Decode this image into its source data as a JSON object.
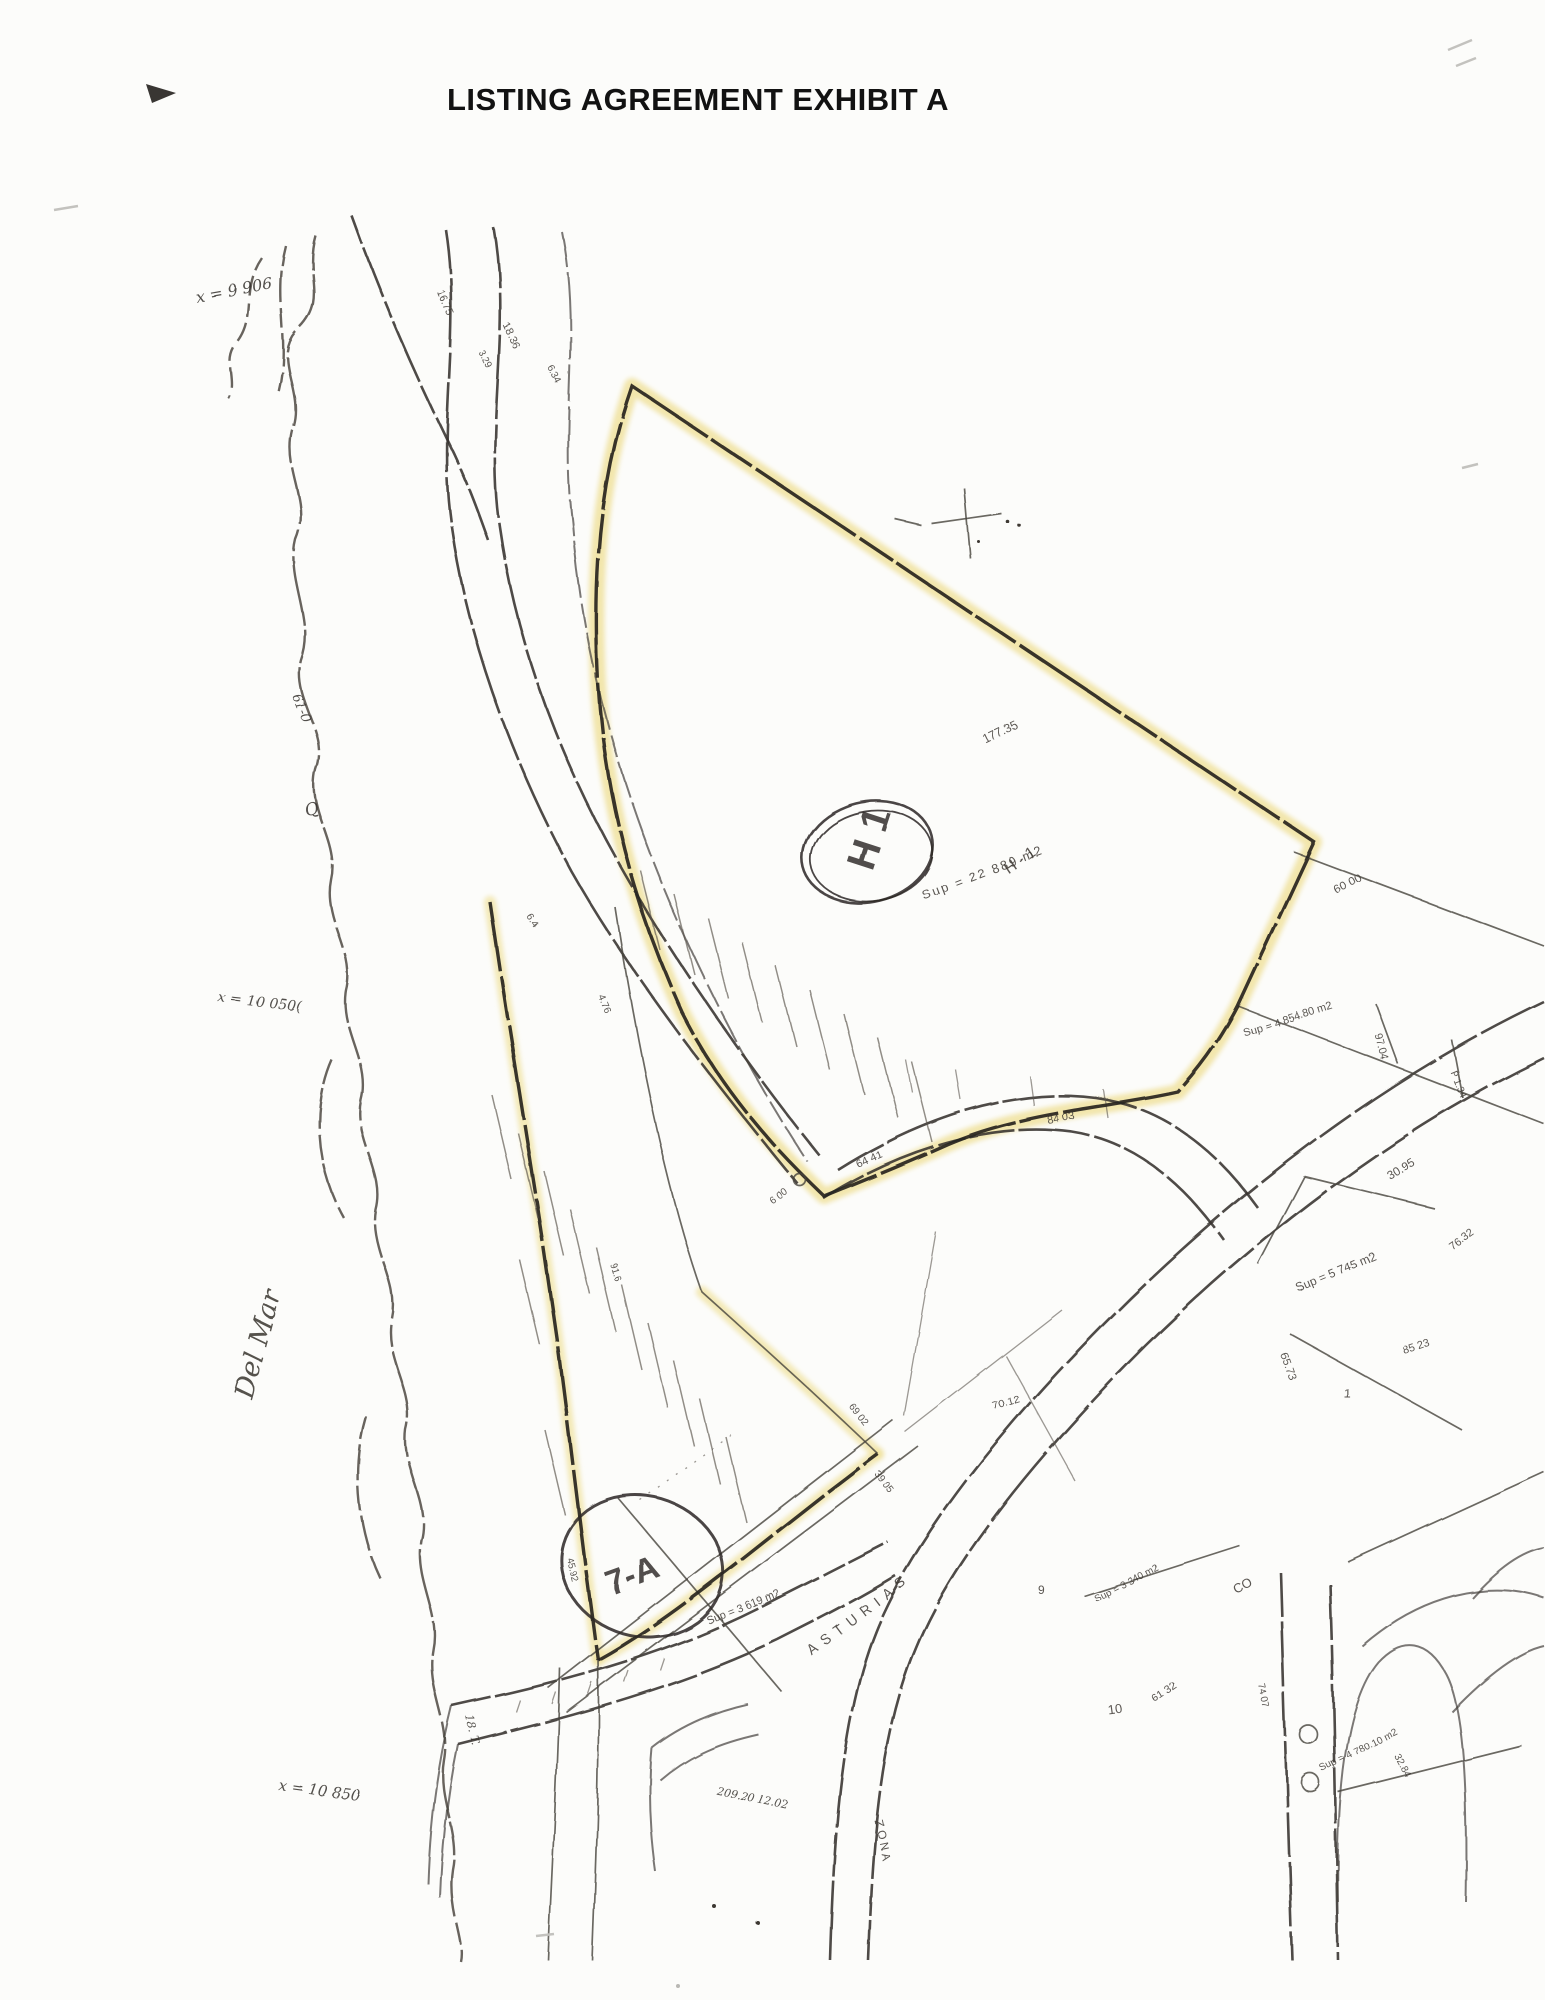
{
  "page": {
    "title": "LISTING AGREEMENT EXHIBIT A"
  },
  "colors": {
    "highlight": "#efe098",
    "ink": "#2f2b27",
    "paper": "#fcfcfa",
    "artifact_gray": "#c3c2be"
  },
  "map": {
    "stamps": {
      "h1_parcel": {
        "label": "H 1"
      },
      "parcel_7a": {
        "label": "7-A"
      }
    },
    "labels": [
      {
        "t": "x = 9 906",
        "x": 196,
        "y": 302,
        "r": -10,
        "s": 16,
        "f": "hand"
      },
      {
        "t": "16.75",
        "x": 437,
        "y": 292,
        "r": 66,
        "s": 11
      },
      {
        "t": "18.36",
        "x": 503,
        "y": 325,
        "r": 66,
        "s": 11
      },
      {
        "t": "3.29",
        "x": 478,
        "y": 352,
        "r": 62,
        "s": 10
      },
      {
        "t": "6.34",
        "x": 548,
        "y": 368,
        "r": 62,
        "s": 10
      },
      {
        "t": "61-0",
        "x": 292,
        "y": 696,
        "r": 68,
        "s": 13,
        "f": "hand"
      },
      {
        "t": "Q",
        "x": 306,
        "y": 816,
        "r": -15,
        "s": 17,
        "f": "hand"
      },
      {
        "t": "x = 10 050(",
        "x": 218,
        "y": 1002,
        "r": 6,
        "s": 14,
        "f": "hand"
      },
      {
        "t": "Del Mar",
        "x": 252,
        "y": 1400,
        "r": -75,
        "s": 27,
        "f": "script"
      },
      {
        "t": "177.35",
        "x": 986,
        "y": 744,
        "r": -26,
        "s": 12
      },
      {
        "t": "H - 1",
        "x": 1008,
        "y": 874,
        "r": -34,
        "s": 16
      },
      {
        "t": "Sup = 22 889 m2",
        "x": 924,
        "y": 900,
        "r": -21,
        "s": 13,
        "ls": 2
      },
      {
        "t": "60 00",
        "x": 1336,
        "y": 894,
        "r": -27,
        "s": 12
      },
      {
        "t": "Sup = 4 854.80 m2",
        "x": 1244,
        "y": 1036,
        "r": -17,
        "s": 11
      },
      {
        "t": "97.04",
        "x": 1374,
        "y": 1034,
        "r": 74,
        "s": 11
      },
      {
        "t": "P 1.34",
        "x": 1450,
        "y": 1072,
        "r": 68,
        "s": 10
      },
      {
        "t": "30.95",
        "x": 1390,
        "y": 1180,
        "r": -30,
        "s": 12
      },
      {
        "t": "76.32",
        "x": 1452,
        "y": 1250,
        "r": -36,
        "s": 11
      },
      {
        "t": "Sup = 5 745 m2",
        "x": 1298,
        "y": 1292,
        "r": -23,
        "s": 12
      },
      {
        "t": "65.73",
        "x": 1280,
        "y": 1354,
        "r": 71,
        "s": 11
      },
      {
        "t": "85 23",
        "x": 1404,
        "y": 1354,
        "r": -18,
        "s": 11
      },
      {
        "t": "1",
        "x": 1344,
        "y": 1398,
        "r": 0,
        "s": 13
      },
      {
        "t": "64 41",
        "x": 858,
        "y": 1168,
        "r": -24,
        "s": 11
      },
      {
        "t": "84 03",
        "x": 1048,
        "y": 1124,
        "r": -11,
        "s": 11
      },
      {
        "t": "6 00",
        "x": 772,
        "y": 1204,
        "r": -35,
        "s": 10
      },
      {
        "t": "70.12",
        "x": 994,
        "y": 1410,
        "r": -17,
        "s": 11
      },
      {
        "t": "Sup = 3 340 m2",
        "x": 1096,
        "y": 1602,
        "r": -27,
        "s": 10
      },
      {
        "t": "ASTURIAS",
        "x": 812,
        "y": 1656,
        "r": -37,
        "s": 14,
        "ls": 7
      },
      {
        "t": "61 32",
        "x": 1154,
        "y": 1702,
        "r": -34,
        "s": 11
      },
      {
        "t": "CO",
        "x": 1236,
        "y": 1594,
        "r": -28,
        "s": 13
      },
      {
        "t": "10",
        "x": 1108,
        "y": 1714,
        "r": -8,
        "s": 13
      },
      {
        "t": "9",
        "x": 1038,
        "y": 1594,
        "r": 0,
        "s": 12
      },
      {
        "t": "74 07",
        "x": 1258,
        "y": 1684,
        "r": 78,
        "s": 10
      },
      {
        "t": "32.84",
        "x": 1394,
        "y": 1756,
        "r": 62,
        "s": 10
      },
      {
        "t": "Sup = 4 780.10 m2",
        "x": 1322,
        "y": 1772,
        "r": -27,
        "s": 10
      },
      {
        "t": "209.20  12.02",
        "x": 716,
        "y": 1794,
        "r": 12,
        "s": 11,
        "f": "hand"
      },
      {
        "t": "ZONA",
        "x": 874,
        "y": 1820,
        "r": 78,
        "s": 12,
        "ls": 3
      },
      {
        "t": "45.92",
        "x": 566,
        "y": 1558,
        "r": 76,
        "s": 10
      },
      {
        "t": "x = 10 850",
        "x": 278,
        "y": 1790,
        "r": 8,
        "s": 15,
        "f": "hand"
      },
      {
        "t": "18. T.",
        "x": 466,
        "y": 1716,
        "r": 78,
        "s": 11,
        "f": "hand"
      },
      {
        "t": "4.76",
        "x": 598,
        "y": 996,
        "r": 68,
        "s": 10
      },
      {
        "t": "6.4",
        "x": 526,
        "y": 916,
        "r": 58,
        "s": 10
      },
      {
        "t": "91.6",
        "x": 610,
        "y": 1264,
        "r": 73,
        "s": 10
      },
      {
        "t": "69 02",
        "x": 848,
        "y": 1406,
        "r": 52,
        "s": 10
      },
      {
        "t": "39 05",
        "x": 874,
        "y": 1474,
        "r": 52,
        "s": 10
      },
      {
        "t": "Sup = 3 619 m2",
        "x": 708,
        "y": 1624,
        "r": -21,
        "s": 11
      }
    ]
  }
}
